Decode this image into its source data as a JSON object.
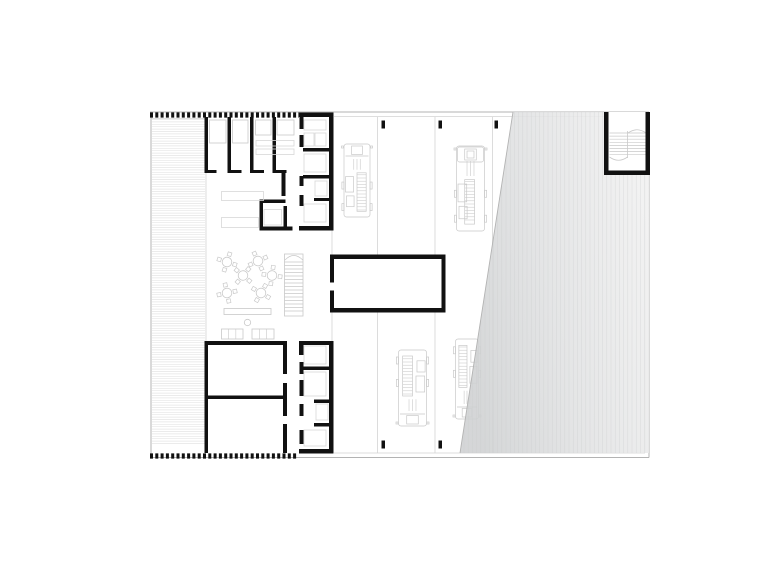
{
  "page": {
    "background": "#ffffff",
    "width": 780,
    "height": 584
  },
  "colors": {
    "wall": "#111111",
    "thin": "#b3b3b3",
    "faint": "#d3d3d3",
    "lt": "#c9c9c9",
    "fx": "#d7d7d7",
    "deck": "#e5e5e5",
    "stripe": "#c8cacb",
    "white": "#ffffff"
  },
  "gradients": [
    {
      "id": "yardGrad",
      "x1": 455,
      "y1": 300,
      "x2": 655,
      "y2": 260,
      "stops": [
        [
          0,
          "#cfd1d2"
        ],
        [
          0.45,
          "#e0e1e2"
        ],
        [
          1,
          "#f0f0f0"
        ]
      ]
    }
  ],
  "clips": [
    {
      "id": "yardClip",
      "pts": "513,112 649,112 649,453 460,453"
    }
  ],
  "primitives": [
    {
      "t": "hl",
      "x": 152,
      "y": 119.5,
      "w": 53,
      "h": 326,
      "gap": 2.4,
      "s": "deck",
      "sw": 0.7,
      "n": "terrace-decking"
    },
    {
      "t": "line",
      "x1": 206,
      "y1": 119,
      "x2": 206,
      "y2": 447,
      "s": "faint",
      "sw": 0.8,
      "n": "terrace-edge"
    },
    {
      "t": "line",
      "x1": 151,
      "y1": 118.5,
      "x2": 206,
      "y2": 118.5,
      "s": "faint",
      "sw": 0.8,
      "n": "terrace-top-edge"
    },
    {
      "t": "line",
      "x1": 151,
      "y1": 112,
      "x2": 151,
      "y2": 457.5,
      "s": "thin",
      "sw": 1,
      "n": "boundary-left"
    },
    {
      "t": "line",
      "x1": 150,
      "y1": 112,
      "x2": 649,
      "y2": 112,
      "s": "thin",
      "sw": 1,
      "n": "boundary-top"
    },
    {
      "t": "line",
      "x1": 334,
      "y1": 116.5,
      "x2": 649,
      "y2": 116.5,
      "s": "faint",
      "sw": 0.8,
      "n": "boundary-top-inner"
    },
    {
      "t": "line",
      "x1": 649,
      "y1": 112,
      "x2": 649,
      "y2": 457.5,
      "s": "thin",
      "sw": 1,
      "n": "boundary-right"
    },
    {
      "t": "line",
      "x1": 645,
      "y1": 116.5,
      "x2": 645,
      "y2": 453,
      "s": "faint",
      "sw": 0.8,
      "n": "boundary-right-inner"
    },
    {
      "t": "line",
      "x1": 150,
      "y1": 457.5,
      "x2": 649,
      "y2": 457.5,
      "s": "thin",
      "sw": 1,
      "n": "boundary-bottom"
    },
    {
      "t": "line",
      "x1": 334,
      "y1": 453,
      "x2": 645,
      "y2": 453,
      "s": "faint",
      "sw": 0.8,
      "n": "boundary-bottom-inner"
    },
    {
      "t": "line",
      "x1": 377.5,
      "y1": 117,
      "x2": 377.5,
      "y2": 453,
      "s": "faint",
      "sw": 0.8,
      "n": "bay-divider-line"
    },
    {
      "t": "line",
      "x1": 435,
      "y1": 117,
      "x2": 435,
      "y2": 453,
      "s": "faint",
      "sw": 0.8,
      "n": "bay-divider-line"
    },
    {
      "t": "line",
      "x1": 492.5,
      "y1": 117,
      "x2": 492.5,
      "y2": 453,
      "s": "faint",
      "sw": 0.8,
      "n": "bay-divider-line"
    },
    {
      "t": "line",
      "x1": 332,
      "y1": 230,
      "x2": 332,
      "y2": 254.5,
      "s": "faint",
      "sw": 0.8,
      "n": "courtyard-hall-edge"
    },
    {
      "t": "line",
      "x1": 332,
      "y1": 312.5,
      "x2": 332,
      "y2": 341,
      "s": "faint",
      "sw": 0.8,
      "n": "courtyard-hall-edge"
    },
    {
      "t": "truck",
      "x": 343.5,
      "y": 142,
      "w": 27,
      "h": 77,
      "lpos": "right",
      "n": "fire-truck-1"
    },
    {
      "t": "truck",
      "x": 456,
      "y": 144,
      "w": 29,
      "h": 89,
      "lpos": "mid",
      "cab": "big",
      "n": "fire-truck-2"
    },
    {
      "t": "truck",
      "x": 398,
      "y": 348,
      "w": 29,
      "h": 80,
      "flip": true,
      "lpos": "left",
      "n": "fire-truck-3"
    },
    {
      "t": "truck",
      "x": 455,
      "y": 337,
      "w": 24,
      "h": 84,
      "flip": true,
      "lpos": "left",
      "n": "fire-truck-4"
    },
    {
      "t": "rect",
      "x": 381.5,
      "y": 120.5,
      "w": 3.5,
      "h": 8,
      "f": "wall",
      "n": "gate-post"
    },
    {
      "t": "rect",
      "x": 438.5,
      "y": 120.5,
      "w": 3.5,
      "h": 8,
      "f": "wall",
      "n": "gate-post"
    },
    {
      "t": "rect",
      "x": 494.5,
      "y": 120.5,
      "w": 3.5,
      "h": 8,
      "f": "wall",
      "n": "gate-post"
    },
    {
      "t": "rect",
      "x": 381.5,
      "y": 440.5,
      "w": 3.5,
      "h": 8,
      "f": "wall",
      "n": "gate-post"
    },
    {
      "t": "rect",
      "x": 438.5,
      "y": 440.5,
      "w": 3.5,
      "h": 8,
      "f": "wall",
      "n": "gate-post"
    },
    {
      "t": "poly",
      "pts": "513,112 649,112 649,453 460,453",
      "f": "url(#yardGrad)",
      "op": 0.88,
      "n": "yard-shade"
    },
    {
      "t": "vl",
      "x": 464,
      "y": 112,
      "w": 182,
      "h": 341,
      "gap": 4.2,
      "s": "stripe",
      "sw": 0.5,
      "op": 0.55,
      "clip": "yardClip",
      "n": "yard-stripes"
    },
    {
      "t": "line",
      "x1": 513,
      "y1": 112,
      "x2": 460,
      "y2": 453,
      "s": "thin",
      "sw": 0.9,
      "n": "yard-edge"
    },
    {
      "t": "rect",
      "x": 604,
      "y": 112,
      "w": 46,
      "h": 63,
      "f": "white",
      "n": "stairwell-floor"
    },
    {
      "t": "hl",
      "x": 609.5,
      "y": 133,
      "w": 36,
      "h": 22,
      "gap": 3.1,
      "s": "lt",
      "sw": 0.7,
      "n": "stair-treads"
    },
    {
      "t": "line",
      "x1": 627.5,
      "y1": 131,
      "x2": 627.5,
      "y2": 158,
      "s": "lt",
      "sw": 0.8,
      "n": "stair-mid-line"
    },
    {
      "t": "path",
      "d": "M 609.5 157 q 9 6.5 18 0",
      "s": "lt",
      "sw": 0.8,
      "n": "stair-arrow-curve"
    },
    {
      "t": "path",
      "d": "M 628 133 q 9 -6.5 18 0",
      "s": "lt",
      "sw": 0.8,
      "n": "stair-arrow-curve"
    },
    {
      "t": "rect",
      "x": 604,
      "y": 112,
      "w": 4.5,
      "h": 63,
      "f": "wall",
      "n": "stairwell-wall"
    },
    {
      "t": "rect",
      "x": 645.5,
      "y": 112,
      "w": 4.5,
      "h": 63,
      "f": "wall",
      "n": "stairwell-wall"
    },
    {
      "t": "rect",
      "x": 604,
      "y": 170.5,
      "w": 46,
      "h": 4.5,
      "f": "wall",
      "n": "stairwell-wall"
    },
    {
      "t": "line",
      "x1": 150,
      "y1": 115,
      "x2": 299,
      "y2": 115,
      "s": "wall",
      "sw": 5.2,
      "dash": "3 2.3",
      "n": "hatch-wall-top"
    },
    {
      "t": "line",
      "x1": 150,
      "y1": 456,
      "x2": 298,
      "y2": 456,
      "s": "wall",
      "sw": 5.2,
      "dash": "3 2.3",
      "n": "hatch-wall-bottom"
    },
    {
      "t": "rect",
      "x": 299,
      "y": 112.5,
      "w": 34.5,
      "h": 4.5,
      "f": "wall",
      "n": "top-block-top-wall"
    },
    {
      "t": "rect",
      "x": 329,
      "y": 112.5,
      "w": 4.5,
      "h": 117.5,
      "f": "wall",
      "n": "top-block-right-wall"
    },
    {
      "t": "rect",
      "x": 299,
      "y": 226,
      "w": 34.5,
      "h": 4.5,
      "f": "wall",
      "n": "top-block-bottom-wall"
    },
    {
      "t": "rect",
      "x": 204.5,
      "y": 117,
      "w": 3.5,
      "h": 56,
      "f": "wall",
      "n": "top-block-left-wall"
    },
    {
      "t": "rect",
      "x": 227.5,
      "y": 117,
      "w": 3.5,
      "h": 53,
      "f": "wall",
      "n": "dorm-divider-wall"
    },
    {
      "t": "rect",
      "x": 250,
      "y": 117,
      "w": 3.5,
      "h": 53,
      "f": "wall",
      "n": "dorm-divider-wall"
    },
    {
      "t": "rect",
      "x": 272.5,
      "y": 117,
      "w": 3.5,
      "h": 53,
      "f": "wall",
      "n": "dorm-divider-wall"
    },
    {
      "t": "rect",
      "x": 204.5,
      "y": 170,
      "w": 12,
      "h": 3,
      "f": "wall",
      "n": "door-stub"
    },
    {
      "t": "rect",
      "x": 227.5,
      "y": 170,
      "w": 14,
      "h": 3,
      "f": "wall",
      "n": "door-stub"
    },
    {
      "t": "rect",
      "x": 250,
      "y": 170,
      "w": 14,
      "h": 3,
      "f": "wall",
      "n": "door-stub"
    },
    {
      "t": "rect",
      "x": 272.5,
      "y": 170,
      "w": 14,
      "h": 3,
      "f": "wall",
      "n": "door-stub"
    },
    {
      "t": "rect",
      "x": 281.5,
      "y": 173,
      "w": 4,
      "h": 23,
      "f": "wall",
      "n": "corridor-wall"
    },
    {
      "t": "rect",
      "x": 299.5,
      "y": 117,
      "w": 4,
      "h": 12,
      "f": "wall",
      "n": "corridor-wall"
    },
    {
      "t": "rect",
      "x": 299.5,
      "y": 135,
      "w": 4,
      "h": 12,
      "f": "wall",
      "n": "corridor-wall"
    },
    {
      "t": "rect",
      "x": 299.5,
      "y": 176,
      "w": 4,
      "h": 10,
      "f": "wall",
      "n": "corridor-wall"
    },
    {
      "t": "rect",
      "x": 299.5,
      "y": 195,
      "w": 4,
      "h": 11,
      "f": "wall",
      "n": "corridor-wall"
    },
    {
      "t": "rect",
      "x": 303,
      "y": 148,
      "w": 26,
      "h": 3.5,
      "f": "wall",
      "n": "wc-divider-wall"
    },
    {
      "t": "rect",
      "x": 303,
      "y": 175,
      "w": 26,
      "h": 3.5,
      "f": "wall",
      "n": "wc-divider-wall"
    },
    {
      "t": "rect",
      "x": 314,
      "y": 198,
      "w": 15,
      "h": 3,
      "f": "wall",
      "n": "wc-divider-wall"
    },
    {
      "t": "rect",
      "x": 209.5,
      "y": 120,
      "w": 16.5,
      "h": 23,
      "s": "lt",
      "n": "bed"
    },
    {
      "t": "rect",
      "x": 232.5,
      "y": 120,
      "w": 15.5,
      "h": 23,
      "s": "lt",
      "n": "bed"
    },
    {
      "t": "rect",
      "x": 255.5,
      "y": 120,
      "w": 15.5,
      "h": 15,
      "s": "lt",
      "n": "wardrobe"
    },
    {
      "t": "rect",
      "x": 277,
      "y": 120,
      "w": 17,
      "h": 15,
      "s": "lt",
      "n": "wardrobe"
    },
    {
      "t": "rect",
      "x": 256,
      "y": 140.5,
      "w": 38,
      "h": 5.5,
      "s": "fx",
      "n": "shelf"
    },
    {
      "t": "rect",
      "x": 256,
      "y": 149,
      "w": 38,
      "h": 5.5,
      "s": "fx",
      "n": "shelf"
    },
    {
      "t": "rect",
      "x": 304,
      "y": 120,
      "w": 22,
      "h": 10,
      "s": "fx",
      "n": "fixture"
    },
    {
      "t": "rect",
      "x": 304,
      "y": 133,
      "w": 10,
      "h": 13,
      "s": "fx",
      "n": "fixture"
    },
    {
      "t": "rect",
      "x": 315,
      "y": 133,
      "w": 11,
      "h": 13,
      "s": "fx",
      "n": "fixture"
    },
    {
      "t": "rect",
      "x": 304,
      "y": 154,
      "w": 22,
      "h": 18,
      "s": "fx",
      "n": "fixture"
    },
    {
      "t": "rect",
      "x": 315,
      "y": 181,
      "w": 12,
      "h": 15,
      "s": "fx",
      "n": "fixture"
    },
    {
      "t": "rect",
      "x": 304,
      "y": 204,
      "w": 22,
      "h": 18,
      "s": "fx",
      "n": "fixture"
    },
    {
      "t": "rect",
      "x": 259.5,
      "y": 199.5,
      "w": 26,
      "h": 3.5,
      "f": "wall",
      "n": "small-room-wall"
    },
    {
      "t": "rect",
      "x": 259.5,
      "y": 199.5,
      "w": 3.5,
      "h": 31,
      "f": "wall",
      "n": "small-room-wall"
    },
    {
      "t": "rect",
      "x": 259.5,
      "y": 226.5,
      "w": 33,
      "h": 4,
      "f": "wall",
      "n": "small-room-wall"
    },
    {
      "t": "rect",
      "x": 283.5,
      "y": 206,
      "w": 3.5,
      "h": 24.5,
      "f": "wall",
      "n": "small-room-wall"
    },
    {
      "t": "rect",
      "x": 264,
      "y": 209.5,
      "w": 17.5,
      "h": 15.5,
      "s": "fx",
      "n": "small-room-fixture"
    },
    {
      "t": "rect",
      "x": 221.5,
      "y": 191.5,
      "w": 42,
      "h": 9,
      "s": "fx",
      "n": "locker-row"
    },
    {
      "t": "rect",
      "x": 221.5,
      "y": 217.5,
      "w": 37,
      "h": 10,
      "s": "fx",
      "n": "locker-row"
    },
    {
      "t": "table",
      "cx": 227,
      "cy": 262,
      "rot": 18,
      "n": "round-table"
    },
    {
      "t": "table",
      "cx": 258,
      "cy": 261,
      "rot": -25,
      "n": "round-table"
    },
    {
      "t": "table",
      "cx": 243,
      "cy": 275.5,
      "rot": 40,
      "n": "round-table"
    },
    {
      "t": "table",
      "cx": 272,
      "cy": 275.5,
      "rot": 8,
      "n": "round-table"
    },
    {
      "t": "table",
      "cx": 227,
      "cy": 293,
      "rot": -12,
      "n": "round-table"
    },
    {
      "t": "table",
      "cx": 261,
      "cy": 293,
      "rot": 30,
      "n": "round-table"
    },
    {
      "t": "rect",
      "x": 284.5,
      "y": 254,
      "w": 18.5,
      "h": 62,
      "s": "lt",
      "n": "courtyard-stair"
    },
    {
      "t": "hl",
      "x": 284.5,
      "y": 262,
      "w": 18.5,
      "h": 50,
      "gap": 3.5,
      "s": "lt",
      "sw": 0.7,
      "n": "courtyard-stair-treads"
    },
    {
      "t": "path",
      "d": "M 285 260 Q 293.7 251 302.8 260",
      "s": "lt",
      "sw": 0.8,
      "n": "courtyard-stair-curve"
    },
    {
      "t": "rect",
      "x": 224,
      "y": 308.5,
      "w": 47,
      "h": 6,
      "s": "lt",
      "n": "counter-table"
    },
    {
      "t": "circle",
      "cx": 247.5,
      "cy": 322.5,
      "r": 3.2,
      "s": "lt",
      "n": "stool"
    },
    {
      "t": "sofa",
      "x": 221.5,
      "y": 329,
      "w": 21.5,
      "h": 10,
      "n": "sofa"
    },
    {
      "t": "sofa",
      "x": 252,
      "y": 329,
      "w": 22,
      "h": 10,
      "n": "sofa"
    },
    {
      "t": "rect",
      "x": 330,
      "y": 254.5,
      "w": 115.5,
      "h": 58,
      "f": "white",
      "n": "workshop-floor"
    },
    {
      "t": "rect",
      "x": 330,
      "y": 254.5,
      "w": 115.5,
      "h": 4.5,
      "f": "wall",
      "n": "workshop-wall"
    },
    {
      "t": "rect",
      "x": 330,
      "y": 308,
      "w": 115.5,
      "h": 4.5,
      "f": "wall",
      "n": "workshop-wall"
    },
    {
      "t": "rect",
      "x": 441.5,
      "y": 254.5,
      "w": 4,
      "h": 58,
      "f": "wall",
      "n": "workshop-wall"
    },
    {
      "t": "rect",
      "x": 330,
      "y": 254.5,
      "w": 4,
      "h": 28,
      "f": "wall",
      "n": "workshop-wall"
    },
    {
      "t": "rect",
      "x": 330,
      "y": 290.5,
      "w": 4,
      "h": 22,
      "f": "wall",
      "n": "workshop-wall"
    },
    {
      "t": "rect",
      "x": 204.5,
      "y": 341,
      "w": 81,
      "h": 4,
      "f": "wall",
      "n": "bottom-block-top-wall"
    },
    {
      "t": "rect",
      "x": 299,
      "y": 341,
      "w": 34.5,
      "h": 4,
      "f": "wall",
      "n": "bottom-block-top-wall"
    },
    {
      "t": "rect",
      "x": 299,
      "y": 345,
      "w": 3.5,
      "h": 10,
      "f": "wall",
      "n": "wall-stub"
    },
    {
      "t": "rect",
      "x": 204.5,
      "y": 341,
      "w": 3.5,
      "h": 112,
      "f": "wall",
      "n": "bottom-block-left-wall"
    },
    {
      "t": "rect",
      "x": 204.5,
      "y": 395.5,
      "w": 78.5,
      "h": 3.5,
      "f": "wall",
      "n": "bottom-block-divider"
    },
    {
      "t": "rect",
      "x": 283,
      "y": 341,
      "w": 4,
      "h": 33,
      "f": "wall",
      "n": "bottom-block-center-wall"
    },
    {
      "t": "rect",
      "x": 283,
      "y": 383,
      "w": 4,
      "h": 33,
      "f": "wall",
      "n": "bottom-block-center-wall"
    },
    {
      "t": "rect",
      "x": 283,
      "y": 424,
      "w": 4,
      "h": 29,
      "f": "wall",
      "n": "bottom-block-center-wall"
    },
    {
      "t": "rect",
      "x": 329,
      "y": 341,
      "w": 4.5,
      "h": 112.5,
      "f": "wall",
      "n": "bottom-block-right-wall"
    },
    {
      "t": "rect",
      "x": 299,
      "y": 449,
      "w": 34.5,
      "h": 4.5,
      "f": "wall",
      "n": "bottom-block-bottom-wall"
    },
    {
      "t": "rect",
      "x": 303,
      "y": 366.5,
      "w": 26,
      "h": 3.5,
      "f": "wall",
      "n": "wc-divider-wall"
    },
    {
      "t": "rect",
      "x": 314,
      "y": 399.5,
      "w": 15.5,
      "h": 3.5,
      "f": "wall",
      "n": "wc-divider-wall"
    },
    {
      "t": "rect",
      "x": 314,
      "y": 423,
      "w": 15.5,
      "h": 3.5,
      "f": "wall",
      "n": "wc-divider-wall"
    },
    {
      "t": "rect",
      "x": 299.5,
      "y": 345,
      "w": 4,
      "h": 10,
      "f": "wall",
      "n": "corridor-wall"
    },
    {
      "t": "rect",
      "x": 299.5,
      "y": 362,
      "w": 4,
      "h": 12,
      "f": "wall",
      "n": "corridor-wall"
    },
    {
      "t": "rect",
      "x": 299.5,
      "y": 380,
      "w": 4,
      "h": 16,
      "f": "wall",
      "n": "corridor-wall"
    },
    {
      "t": "rect",
      "x": 299.5,
      "y": 404,
      "w": 4,
      "h": 12,
      "f": "wall",
      "n": "corridor-wall"
    },
    {
      "t": "rect",
      "x": 299.5,
      "y": 430,
      "w": 4,
      "h": 14,
      "f": "wall",
      "n": "corridor-wall"
    },
    {
      "t": "rect",
      "x": 304,
      "y": 346,
      "w": 22,
      "h": 18,
      "s": "fx",
      "n": "fixture"
    },
    {
      "t": "rect",
      "x": 304,
      "y": 372,
      "w": 22,
      "h": 24,
      "s": "fx",
      "n": "fixture"
    },
    {
      "t": "rect",
      "x": 316,
      "y": 404,
      "w": 12,
      "h": 16,
      "s": "fx",
      "n": "fixture"
    },
    {
      "t": "rect",
      "x": 304,
      "y": 430,
      "w": 22,
      "h": 16,
      "s": "fx",
      "n": "fixture"
    }
  ]
}
